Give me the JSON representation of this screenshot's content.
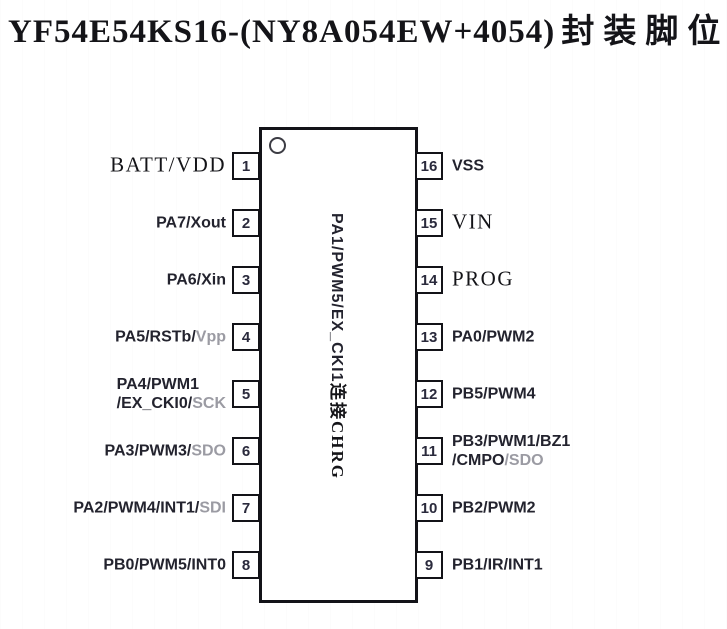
{
  "colors": {
    "background": "#ffffff",
    "ink": "#141418",
    "sans_label_ink": "#23232e",
    "gray_label_ink": "#9b9ba3",
    "outline": "#131318"
  },
  "title": {
    "part_number": "YF54E54KS16-(NY8A054EW+4054)",
    "suffix_cn": "封装脚位图"
  },
  "chip": {
    "package_pins": 16,
    "pin1_indicator": "circle-icon",
    "center_label": {
      "signal": "PA1/PWM5/EX_CKI1",
      "note_cn": "连接CHRG"
    }
  },
  "pins_left": [
    {
      "number": "1",
      "lines": [
        [
          {
            "text": "BATT/VDD",
            "style": "serif"
          }
        ]
      ]
    },
    {
      "number": "2",
      "lines": [
        [
          {
            "text": "PA7/Xout",
            "style": "sans"
          }
        ]
      ]
    },
    {
      "number": "3",
      "lines": [
        [
          {
            "text": "PA6/Xin",
            "style": "sans"
          }
        ]
      ]
    },
    {
      "number": "4",
      "lines": [
        [
          {
            "text": "PA5/RSTb/",
            "style": "sans"
          },
          {
            "text": "Vpp",
            "style": "gray"
          }
        ]
      ]
    },
    {
      "number": "5",
      "lines": [
        [
          {
            "text": "PA4/PWM1",
            "style": "sans"
          }
        ],
        [
          {
            "text": "/EX_CKI0/",
            "style": "sans"
          },
          {
            "text": "SCK",
            "style": "gray"
          }
        ]
      ]
    },
    {
      "number": "6",
      "lines": [
        [
          {
            "text": "PA3/PWM3/",
            "style": "sans"
          },
          {
            "text": "SDO",
            "style": "gray"
          }
        ]
      ]
    },
    {
      "number": "7",
      "lines": [
        [
          {
            "text": "PA2/PWM4/INT1/",
            "style": "sans"
          },
          {
            "text": "SDI",
            "style": "gray"
          }
        ]
      ]
    },
    {
      "number": "8",
      "lines": [
        [
          {
            "text": "PB0/PWM5/INT0",
            "style": "sans"
          }
        ]
      ]
    }
  ],
  "pins_right": [
    {
      "number": "16",
      "lines": [
        [
          {
            "text": "VSS",
            "style": "sans"
          }
        ]
      ]
    },
    {
      "number": "15",
      "lines": [
        [
          {
            "text": "VIN",
            "style": "serif"
          }
        ]
      ]
    },
    {
      "number": "14",
      "lines": [
        [
          {
            "text": "PROG",
            "style": "serif"
          }
        ]
      ]
    },
    {
      "number": "13",
      "lines": [
        [
          {
            "text": "PA0/PWM2",
            "style": "sans"
          }
        ]
      ]
    },
    {
      "number": "12",
      "lines": [
        [
          {
            "text": "PB5/PWM4",
            "style": "sans"
          }
        ]
      ]
    },
    {
      "number": "11",
      "lines": [
        [
          {
            "text": "PB3/PWM1/BZ1",
            "style": "sans"
          }
        ],
        [
          {
            "text": "/CMPO",
            "style": "sans"
          },
          {
            "text": "/SDO",
            "style": "gray"
          }
        ]
      ]
    },
    {
      "number": "10",
      "lines": [
        [
          {
            "text": "PB2/PWM2",
            "style": "sans"
          }
        ]
      ]
    },
    {
      "number": "9",
      "lines": [
        [
          {
            "text": "PB1/IR/INT1",
            "style": "sans"
          }
        ]
      ]
    }
  ]
}
